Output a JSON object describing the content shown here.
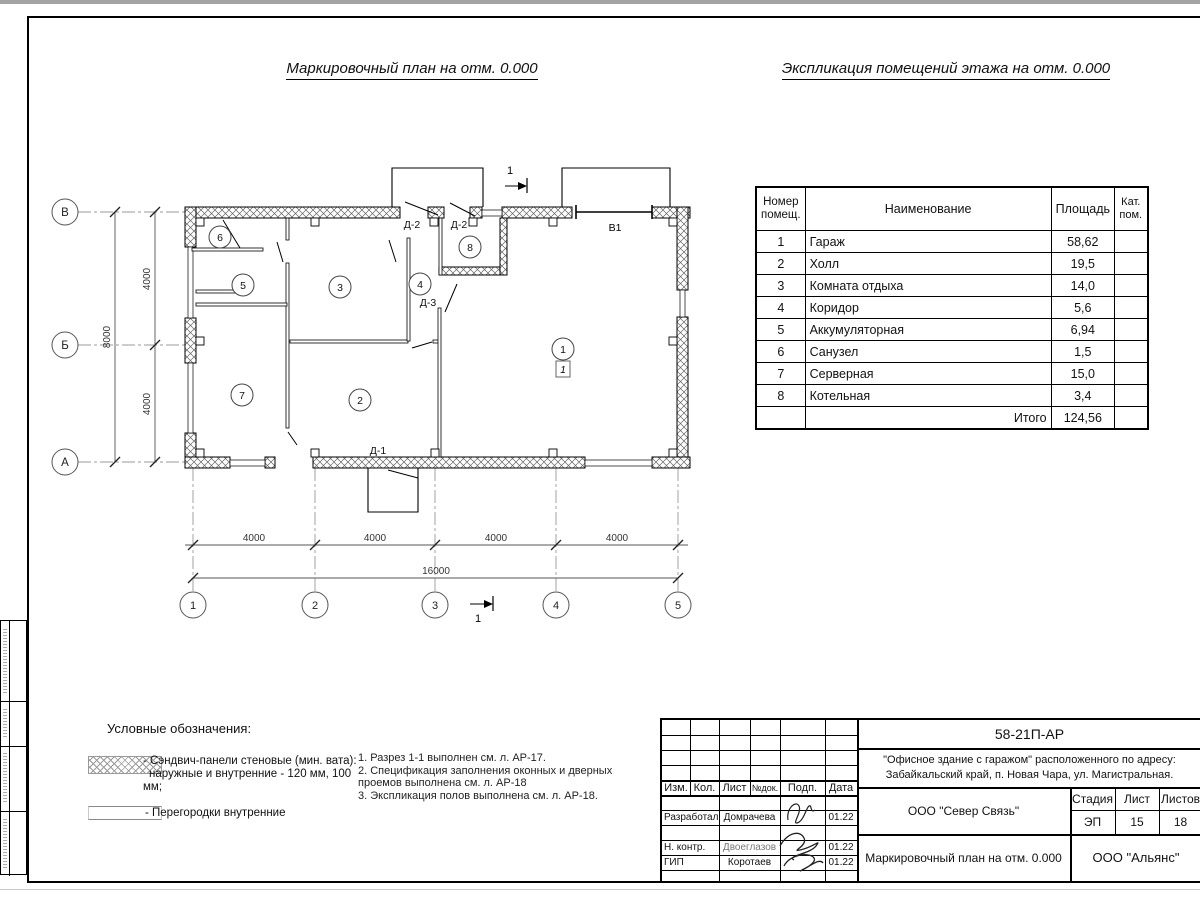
{
  "page": {
    "plan_title": "Маркировочный план на отм. 0.000",
    "explication_title": "Экспликация помещений этажа на отм. 0.000"
  },
  "explication": {
    "headers": {
      "number": "Номер помещ.",
      "name": "Наименование",
      "area": "Площадь",
      "category": "Кат. пом."
    },
    "rows": [
      {
        "n": "1",
        "name": "Гараж",
        "area": "58,62"
      },
      {
        "n": "2",
        "name": "Холл",
        "area": "19,5"
      },
      {
        "n": "3",
        "name": "Комната отдыха",
        "area": "14,0"
      },
      {
        "n": "4",
        "name": "Коридор",
        "area": "5,6"
      },
      {
        "n": "5",
        "name": "Аккумуляторная",
        "area": "6,94"
      },
      {
        "n": "6",
        "name": "Санузел",
        "area": "1,5"
      },
      {
        "n": "7",
        "name": "Серверная",
        "area": "15,0"
      },
      {
        "n": "8",
        "name": "Котельная",
        "area": "3,4"
      }
    ],
    "total_label": "Итого",
    "total_area": "124,56"
  },
  "plan": {
    "col_axes": [
      "1",
      "2",
      "3",
      "4",
      "5"
    ],
    "row_axes": [
      "В",
      "Б",
      "А"
    ],
    "dims_bottom": [
      "4000",
      "4000",
      "4000",
      "4000"
    ],
    "dim_bottom_total": "16000",
    "dims_left": [
      "4000",
      "4000"
    ],
    "dim_left_total": "8000",
    "rooms": [
      "1",
      "2",
      "3",
      "4",
      "5",
      "6",
      "7",
      "8"
    ],
    "floor_mark": "1",
    "doors": {
      "d1": "Д-1",
      "d2a": "Д-2",
      "d2b": "Д-2",
      "d3": "Д-3"
    },
    "gate_label": "В1",
    "section_label": "1"
  },
  "legend": {
    "title": "Условные обозначения:",
    "item1_line1": "- Сэндвич-панели стеновые (мин. вата):",
    "item1_line2": "наружные и внутренние - 120 мм, 100 мм;",
    "item2": "- Перегородки внутренние"
  },
  "notes": {
    "n1": "1. Разрез 1-1 выполнен см. л. АР-17.",
    "n2": "2. Спецификация заполнения оконных и дверных",
    "n2b": "проемов выполнена см. л. АР-18",
    "n3": "3. Экспликация полов выполнена см. л. АР-18."
  },
  "titleblock": {
    "doc_number": "58-21П-АР",
    "project_line1": "\"Офисное здание с гаражом\" расположенного по адресу:",
    "project_line2": "Забайкальский край, п. Новая Чара, ул. Магистральная.",
    "org": "ООО \"Север Связь\"",
    "sheet_title": "Маркировочный план на отм. 0.000",
    "company": "ООО \"Альянс\"",
    "cols": {
      "izm": "Изм.",
      "kol": "Кол.",
      "list": "Лист",
      "ndok": "№док.",
      "podp": "Подп.",
      "data": "Дата"
    },
    "stage_label": "Стадия",
    "sheet_label": "Лист",
    "sheets_label": "Листов",
    "stage": "ЭП",
    "sheet_num": "15",
    "sheets_total": "18",
    "roles": {
      "developed": "Разработал",
      "ncontr": "Н. контр.",
      "gip": "ГИП"
    },
    "names": {
      "developed": "Домрачева",
      "ncontr": "Двоеглазов",
      "gip": "Коротаев"
    },
    "dates": {
      "developed": "01.22",
      "ncontr": "01.22",
      "gip": "01.22"
    }
  }
}
